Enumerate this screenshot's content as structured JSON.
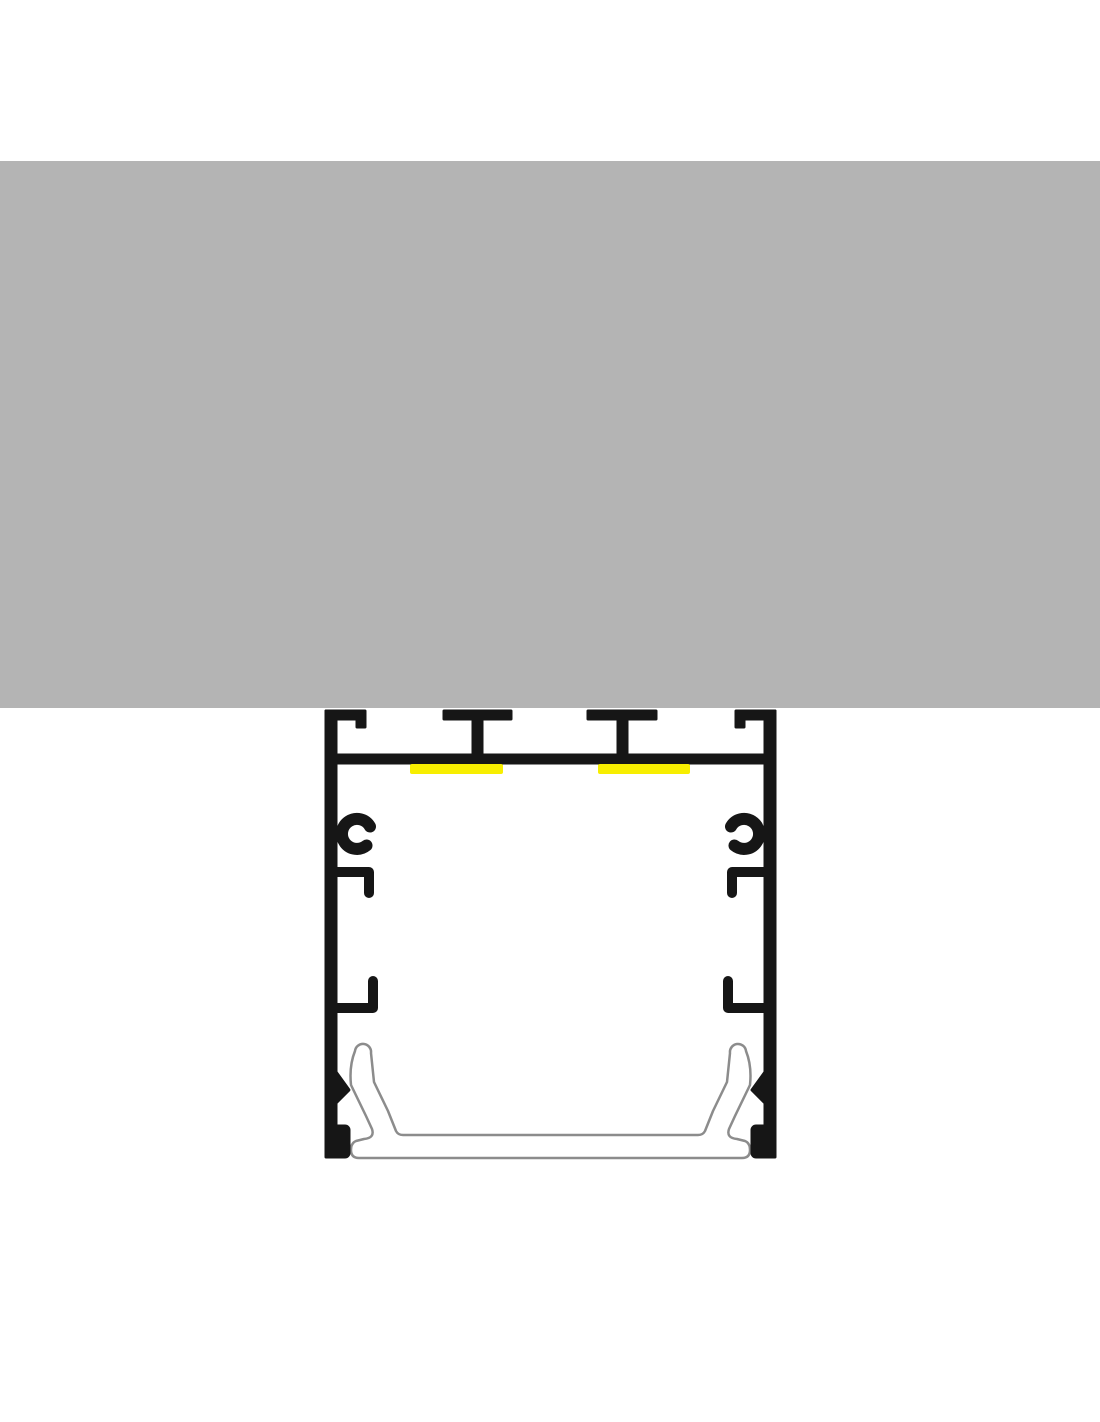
{
  "diagram": {
    "title": "LED aluminium profile ceiling-mount cross-section",
    "components": {
      "ceiling": "ceiling-surface",
      "profile": "aluminium-profile-body",
      "mounting_channel": "top-mounting-channel",
      "t_rail_left": "t-screw-rail-left",
      "t_rail_right": "t-screw-rail-right",
      "led_strip_left": "led-strip-left",
      "led_strip_right": "led-strip-right",
      "screw_boss_left": "screw-port-left",
      "screw_boss_right": "screw-port-right",
      "clip_tab_left": "clip-tab-left",
      "clip_tab_right": "clip-tab-right",
      "diffuser": "snap-in-diffuser-cover"
    }
  },
  "colors": {
    "background": "#ffffff",
    "ceiling": "#b4b4b4",
    "profile": "#161616",
    "led": "#f7ee00",
    "diffuser_fill": "#ffffff",
    "diffuser_stroke": "#8c8c8c"
  }
}
